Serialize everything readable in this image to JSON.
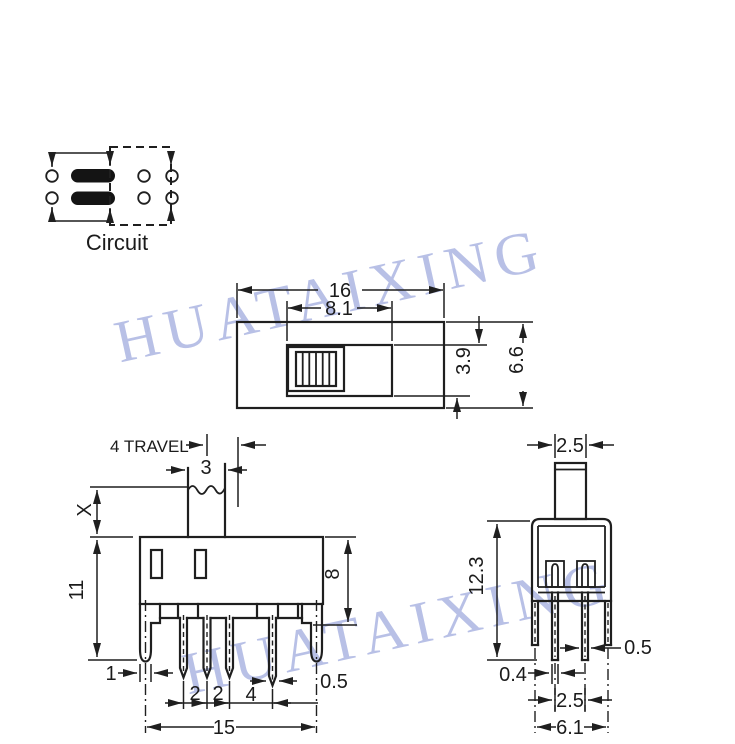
{
  "watermark": {
    "text": "HUATAIXING",
    "color": "#a7b1e0"
  },
  "line_color": "#1f1f1f",
  "circuit": {
    "label": "Circuit"
  },
  "top_view": {
    "overall_width": "16",
    "slot_width": "8.1",
    "slot_height": "3.9",
    "overall_height": "6.6"
  },
  "front_view": {
    "travel": "4 TRAVEL",
    "knob_width": "3",
    "knob_height": "X",
    "body_height": "11",
    "terminal_height": "8",
    "leg_width": "1",
    "pin_pitch_1": "2",
    "pin_pitch_2": "2",
    "pin_pitch_3": "4",
    "pin_width": "0.5",
    "mount_span": "15"
  },
  "side_view": {
    "knob_depth": "2.5",
    "overall_height": "12.3",
    "pin_thickness": "0.5",
    "leg_thickness": "0.4",
    "pin_span": "2.5",
    "leg_span": "6.1"
  }
}
